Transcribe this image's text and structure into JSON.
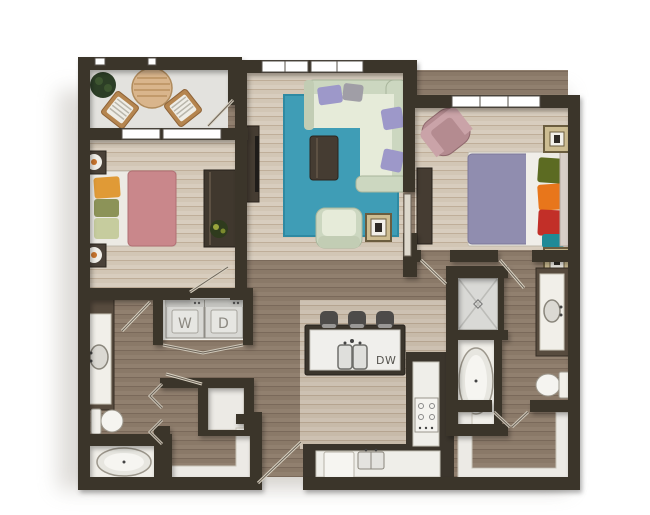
{
  "plan": {
    "labels": {
      "washer": "W",
      "dryer": "D",
      "dishwasher": "DW"
    },
    "colors": {
      "wall": "#3b352c",
      "floor_light": "#d8cdbe",
      "floor_dark": "#91806f",
      "balcony_floor": "#e3e2de",
      "rug_teal": "#3f9db6",
      "sofa_sage": "#ccd7c0",
      "sofa_seat": "#e6ebd9",
      "pillow_purple": "#9d98c9",
      "pillow_gray": "#a09ea6",
      "bed1_rose": "#c9878b",
      "bed2_lavender": "#908daf",
      "armchair_mauve": "#b48b90",
      "wood_dark_furniture": "#453c32",
      "fixture_white": "#f1efe9",
      "appliance_gray": "#d8d8d4",
      "stool_gray": "#4d4b49",
      "pillow_olive": "#5c6b22",
      "pillow_orange": "#e8761b",
      "pillow_red": "#c22f28",
      "pillow_teal": "#1f8a96",
      "pillow_pale_green": "#c6cc9e",
      "plant_green": "#2c3e26",
      "rattan_tan": "#d9b58c",
      "lamp_gold": "#cdbd92"
    }
  }
}
